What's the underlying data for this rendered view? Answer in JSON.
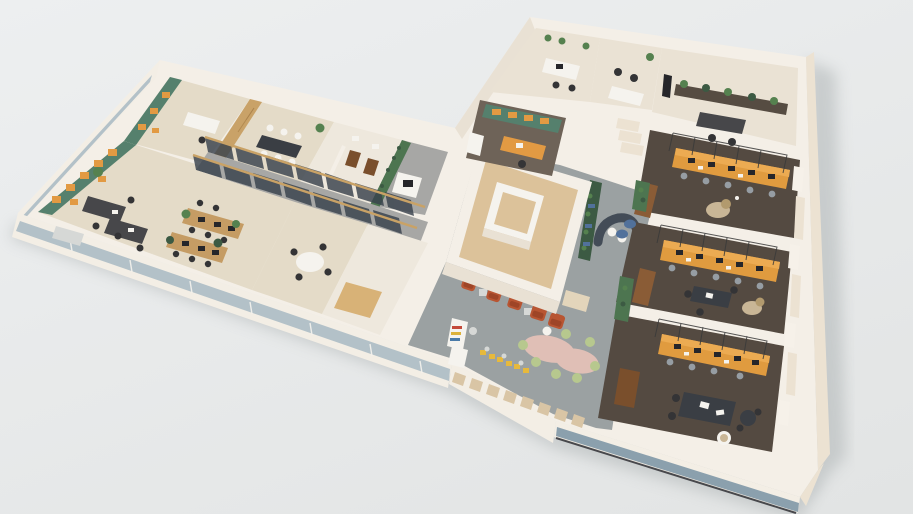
{
  "title": "3D isometric office floor plan render",
  "palette": {
    "bg1": "#edeff0",
    "bg2": "#e2e4e4",
    "shadow": "#aab0b1",
    "cream": "#f4efe7",
    "wallShade": "#e9e1d4",
    "facadeWhite": "#f3eee5",
    "glassLight": "#b3c1c8",
    "glassDark": "#8ba0ad",
    "beigeFace": "#ece2d2",
    "floorBeige": "#e4dbc8",
    "floorLight": "#eae2d4",
    "floorWhite": "#eee8dd",
    "floorGray": "#a7a7a5",
    "circGray": "#9ba1a2",
    "carpetDark": "#544a41",
    "coreTan": "#dcc29a",
    "tealWall": "#55806d",
    "orangeAccent": "#e29a43",
    "benchOrange": "#e09b3f",
    "benchTop": "#ecab52",
    "woodWall": "#c9a268",
    "woodDesk": "#c59c64",
    "deskDark": "#47474a",
    "monitor": "#26262a",
    "chairBlack": "#343436",
    "chairGray": "#969da3",
    "sofaBrown": "#8a5c36",
    "armchairRust": "#b85532",
    "armchairRustDark": "#9e4527",
    "pinkTable": "#e0bfb6",
    "poufGreen": "#b7c88e",
    "plantGreen": "#55814f",
    "plantDark": "#3c5a43",
    "plantWall": "#4d7550",
    "tileBeige": "#d9c5a5",
    "yellowSeat": "#e7b93c",
    "white": "#f5f3ee",
    "glassPanel": "#39424d",
    "railWood": "#c9a266",
    "rug": "#c9b696",
    "wicker": "#b29a6e",
    "tableDark": "#3a3e44",
    "credenza": "#564c42",
    "cabBrown": "#7a4f2c",
    "blueCushion": "#51719b",
    "steelGray": "#d6d8d6",
    "tanInset": "#d8b277",
    "lockerBeige": "#e3d5bb",
    "sofaDark": "#434c57",
    "execFloor": "#6e6358",
    "pilaster": "#f6f1e9",
    "mesh": "#3a3a3a"
  },
  "scene": {
    "view": "axonometric cutaway, roof removed, seen from south-west above",
    "wings": [
      {
        "id": "left-wing",
        "rooms": [
          {
            "id": "corner-office-west",
            "accent": "teal wall with orange cubby shelves",
            "furniture": [
              "dark desks",
              "black chairs",
              "light sofa",
              "plant"
            ]
          },
          {
            "id": "green-office-back",
            "accent": "teal wall with orange cubby shelves",
            "furniture": [
              "white desk",
              "chair"
            ]
          },
          {
            "id": "wood-meeting-room",
            "accent": "oak slat wall",
            "furniture": [
              "conference table",
              "6 white chairs",
              "plant"
            ]
          },
          {
            "id": "service-rooms",
            "furniture": [
              "wc doors"
            ]
          },
          {
            "id": "copy-nook",
            "accent": "living plant wall",
            "furniture": [
              "copier cabinet"
            ]
          },
          {
            "id": "glass-corridor",
            "furniture": [
              "dark glazed partitions, oak rail"
            ]
          },
          {
            "id": "open-office",
            "furniture": [
              "2 wood desk benches",
              "black chairs",
              "plants"
            ]
          },
          {
            "id": "small-meeting-room",
            "furniture": [
              "round white table",
              "4 black chairs"
            ]
          },
          {
            "id": "storage-room",
            "furniture": [
              "tan floor inset"
            ]
          }
        ]
      },
      {
        "id": "center",
        "rooms": [
          {
            "id": "stair-elevator-core",
            "furniture": [
              "inner shaft box",
              "tan floor"
            ]
          },
          {
            "id": "lounge",
            "furniture": [
              "5 rust armchairs",
              "side tables",
              "vending kiosk",
              "fridge",
              "3 yellow cafe seat pairs",
              "pink organic tables",
              "7 green poufs",
              "window tile bench",
              "lockers"
            ]
          },
          {
            "id": "reception",
            "furniture": [
              "curved dark sofa",
              "white poufs",
              "planter bench with blue cushions",
              "steps",
              "plant"
            ]
          }
        ]
      },
      {
        "id": "right-block",
        "rooms": [
          {
            "id": "back-office-1",
            "furniture": [
              "white desk",
              "chairs",
              "sill plants"
            ]
          },
          {
            "id": "back-office-2",
            "furniture": [
              "desk",
              "2 chairs",
              "plant"
            ]
          },
          {
            "id": "back-office-wide",
            "furniture": [
              "plant credenza",
              "dark desk",
              "chairs",
              "tv"
            ]
          },
          {
            "id": "exec-office",
            "accent": "teal wall with orange shelves",
            "furniture": [
              "orange desk",
              "chair",
              "cabinet"
            ]
          },
          {
            "id": "open-plan-a",
            "floor": "dark carpet",
            "furniture": [
              "orange desk bench with mesh frame",
              "5 gray chairs",
              "leather sofa",
              "round rug",
              "wicker chair"
            ]
          },
          {
            "id": "open-plan-b",
            "floor": "dark carpet",
            "furniture": [
              "orange desk bench with mesh frame",
              "5 gray chairs",
              "leather sofa",
              "dark table group",
              "rug"
            ]
          },
          {
            "id": "open-plan-c",
            "floor": "dark carpet",
            "furniture": [
              "orange desk bench with mesh frame",
              "4 gray chairs",
              "brown cabinet",
              "dark desk",
              "white swivel chair",
              "round table"
            ]
          }
        ]
      }
    ],
    "facades": {
      "south": "glass band with white sill",
      "west": "white band with glass strip",
      "east": "beige masonry"
    }
  }
}
